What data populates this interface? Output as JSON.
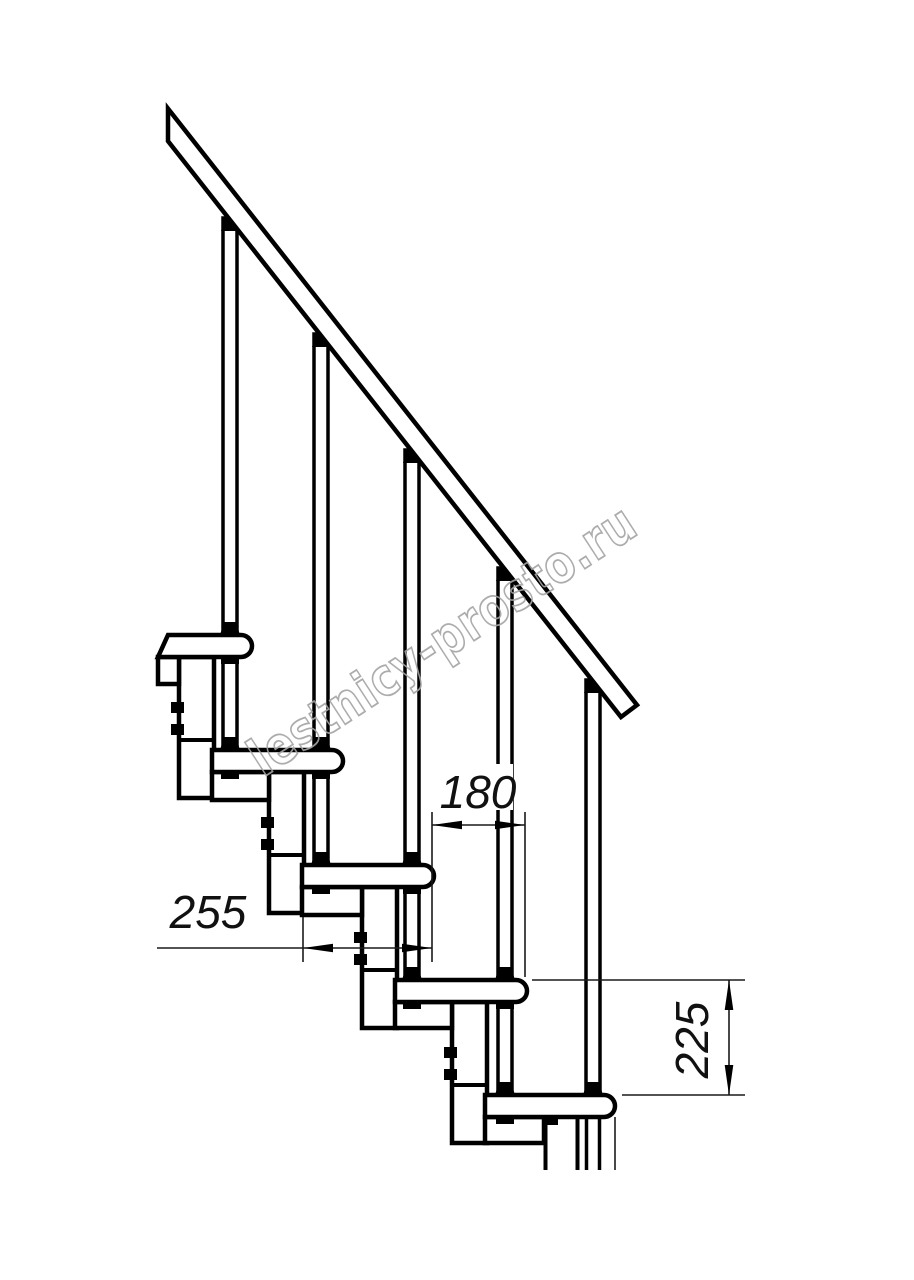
{
  "title": "Modular staircase side elevation drawing",
  "watermark": {
    "text": "lestnicy-prosto.ru",
    "color": "#a4a4a4"
  },
  "dimensions": {
    "run": {
      "label": "180",
      "meaning": "step run between tread edges"
    },
    "depth": {
      "label": "255",
      "meaning": "tread depth"
    },
    "rise": {
      "label": "225",
      "meaning": "step rise"
    }
  },
  "colors": {
    "line": "#000000",
    "dimension": "#1a1a1a",
    "background": "#ffffff"
  },
  "structure": {
    "treads": 5,
    "balusters": 5,
    "support_columns": 5,
    "handrail": true
  }
}
